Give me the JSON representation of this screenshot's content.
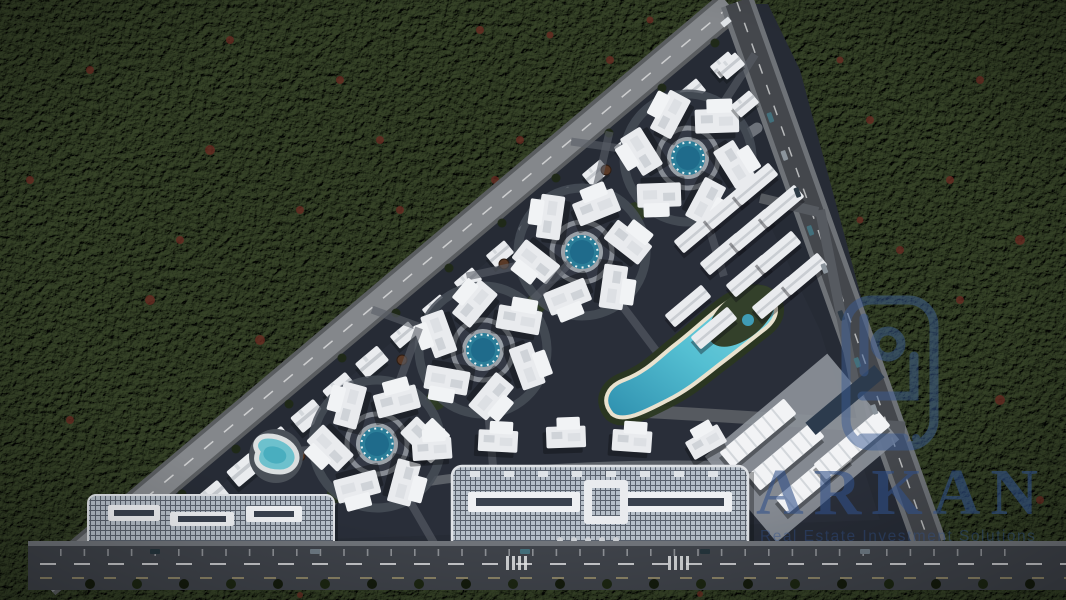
{
  "watermark": {
    "brand": "ARKAN",
    "tagline": "Real Estate Investment Solutions",
    "logo_icon": "arkan-emblem-logo",
    "color": "#30508a"
  },
  "palette": {
    "forest_green": "#49583a",
    "forest_shadow": "#0b0d08",
    "autumn_tree_red": "#6b2a22",
    "site_paving": "#262b35",
    "road_light_gray": "#7e8286",
    "asphalt_dark": "#3f434a",
    "building_white": "#e9ebee",
    "glass_roof_blue_gray": "#b6bfc9",
    "pool_teal": "#2b7e99",
    "lagoon_turquoise": "#54bfd2",
    "beach_sand": "#e9e2cf",
    "court_green": "#3c6a40",
    "landscape_green": "#2c3a22"
  }
}
